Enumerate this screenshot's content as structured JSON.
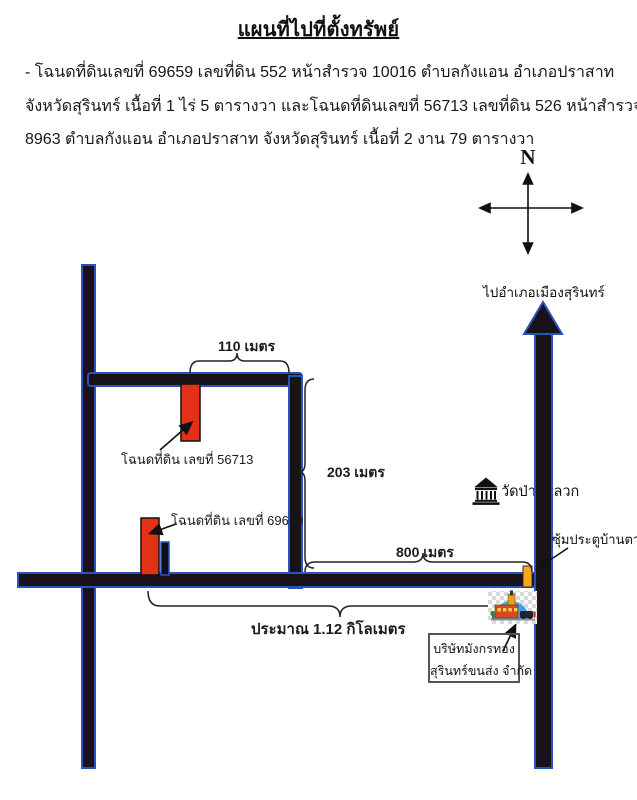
{
  "page": {
    "title": "แผนที่ไปที่ตั้งทรัพย์",
    "description": {
      "line1": "- โฉนดที่ดินเลขที่ 69659 เลขที่ดิน 552 หน้าสำรวจ 10016 ตำบลกังแอน อำเภอปราสาท",
      "line2": "จังหวัดสุรินทร์ เนื้อที่ 1 ไร่ 5 ตารางวา และโฉนดที่ดินเลขที่ 56713 เลขที่ดิน 526 หน้าสำรวจ",
      "line3": "8963 ตำบลกังแอน อำเภอปราสาท  จังหวัดสุรินทร์ เนื้อที่ 2 งาน 79 ตารางวา"
    }
  },
  "compass": {
    "north": "N"
  },
  "map": {
    "distances": {
      "d110": "110 เมตร",
      "d203": "203 เมตร",
      "d800": "800 เมตร",
      "total": "ประมาณ 1.12 กิโลเมตร"
    },
    "places": {
      "to_city": "ไปอำเภอเมืองสุรินทร์",
      "temple": "วัดป่าตาลวก",
      "gate": "ซุ้มประตูบ้านตาลวก",
      "plot_56713": "โฉนดที่ดิน เลขที่ 56713",
      "plot_69659": "โฉนดที่ดิน เลขที่ 69659",
      "company_line1": "บริษัทมังกรทอง",
      "company_line2": "สุรินทร์ขนส่ง จำกัด"
    },
    "colors": {
      "road": "#191219",
      "road_edge": "#2a52be",
      "plot": "#e23019",
      "gate_marker": "#f7a71f"
    }
  }
}
